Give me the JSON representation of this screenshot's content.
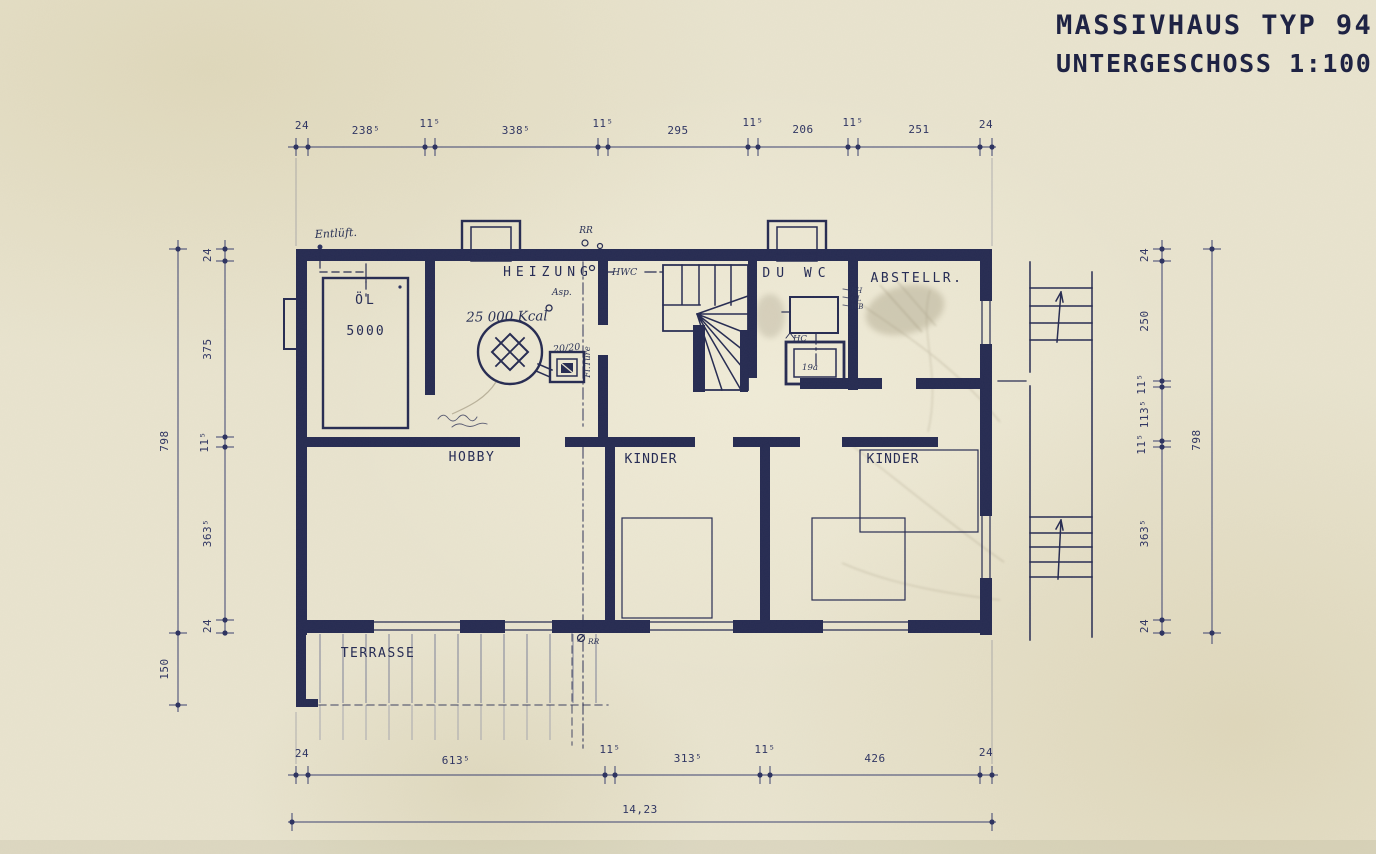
{
  "title": {
    "line1": "MASSIVHAUS TYP 94",
    "line2": "UNTERGESCHOSS 1:100"
  },
  "rooms": {
    "heizung": "HEIZUNG",
    "oel": "ÖL",
    "oel_capacity": "5000",
    "du_wc": "DU WC",
    "abstellraum": "ABSTELLR.",
    "hobby": "HOBBY",
    "kinder_1": "KINDER",
    "kinder_2": "KINDER",
    "terrasse": "TERRASSE"
  },
  "annotations": {
    "entlueftung": "Entlüft.",
    "rainpipe_top": "RR",
    "rainpipe_bottom": "RR",
    "hwc": "HWC",
    "asp": "Asp.",
    "boiler_capacity": "25 000 Kcal",
    "flue": "20/20",
    "fl_tuere": "Fl.Türe",
    "hc": "HC",
    "shower": "19a",
    "note_bh": "BH",
    "note_ol": "OL",
    "note_wb": "WB"
  },
  "dimensions": {
    "top": [
      "24",
      "238⁵",
      "11⁵",
      "338⁵",
      "11⁵",
      "295",
      "11⁵",
      "206",
      "11⁵",
      "251",
      "24"
    ],
    "bottom": [
      "24",
      "613⁵",
      "11⁵",
      "313⁵",
      "11⁵",
      "426",
      "24"
    ],
    "bottom_total": "14,23",
    "left_outer_height": "798",
    "left_outer_terrace": "150",
    "left_inner": [
      "24",
      "375",
      "11⁵",
      "363⁵",
      "24"
    ],
    "right_inner": [
      "24",
      "250",
      "11⁵",
      "113⁵",
      "11⁵",
      "363⁵",
      "24"
    ],
    "right_outer_height": "798"
  },
  "colors": {
    "paper": "#e9e4cf",
    "ink": "#262b52",
    "dimension_line": "#3a4070",
    "pencil_smudge": "#9a9077"
  }
}
